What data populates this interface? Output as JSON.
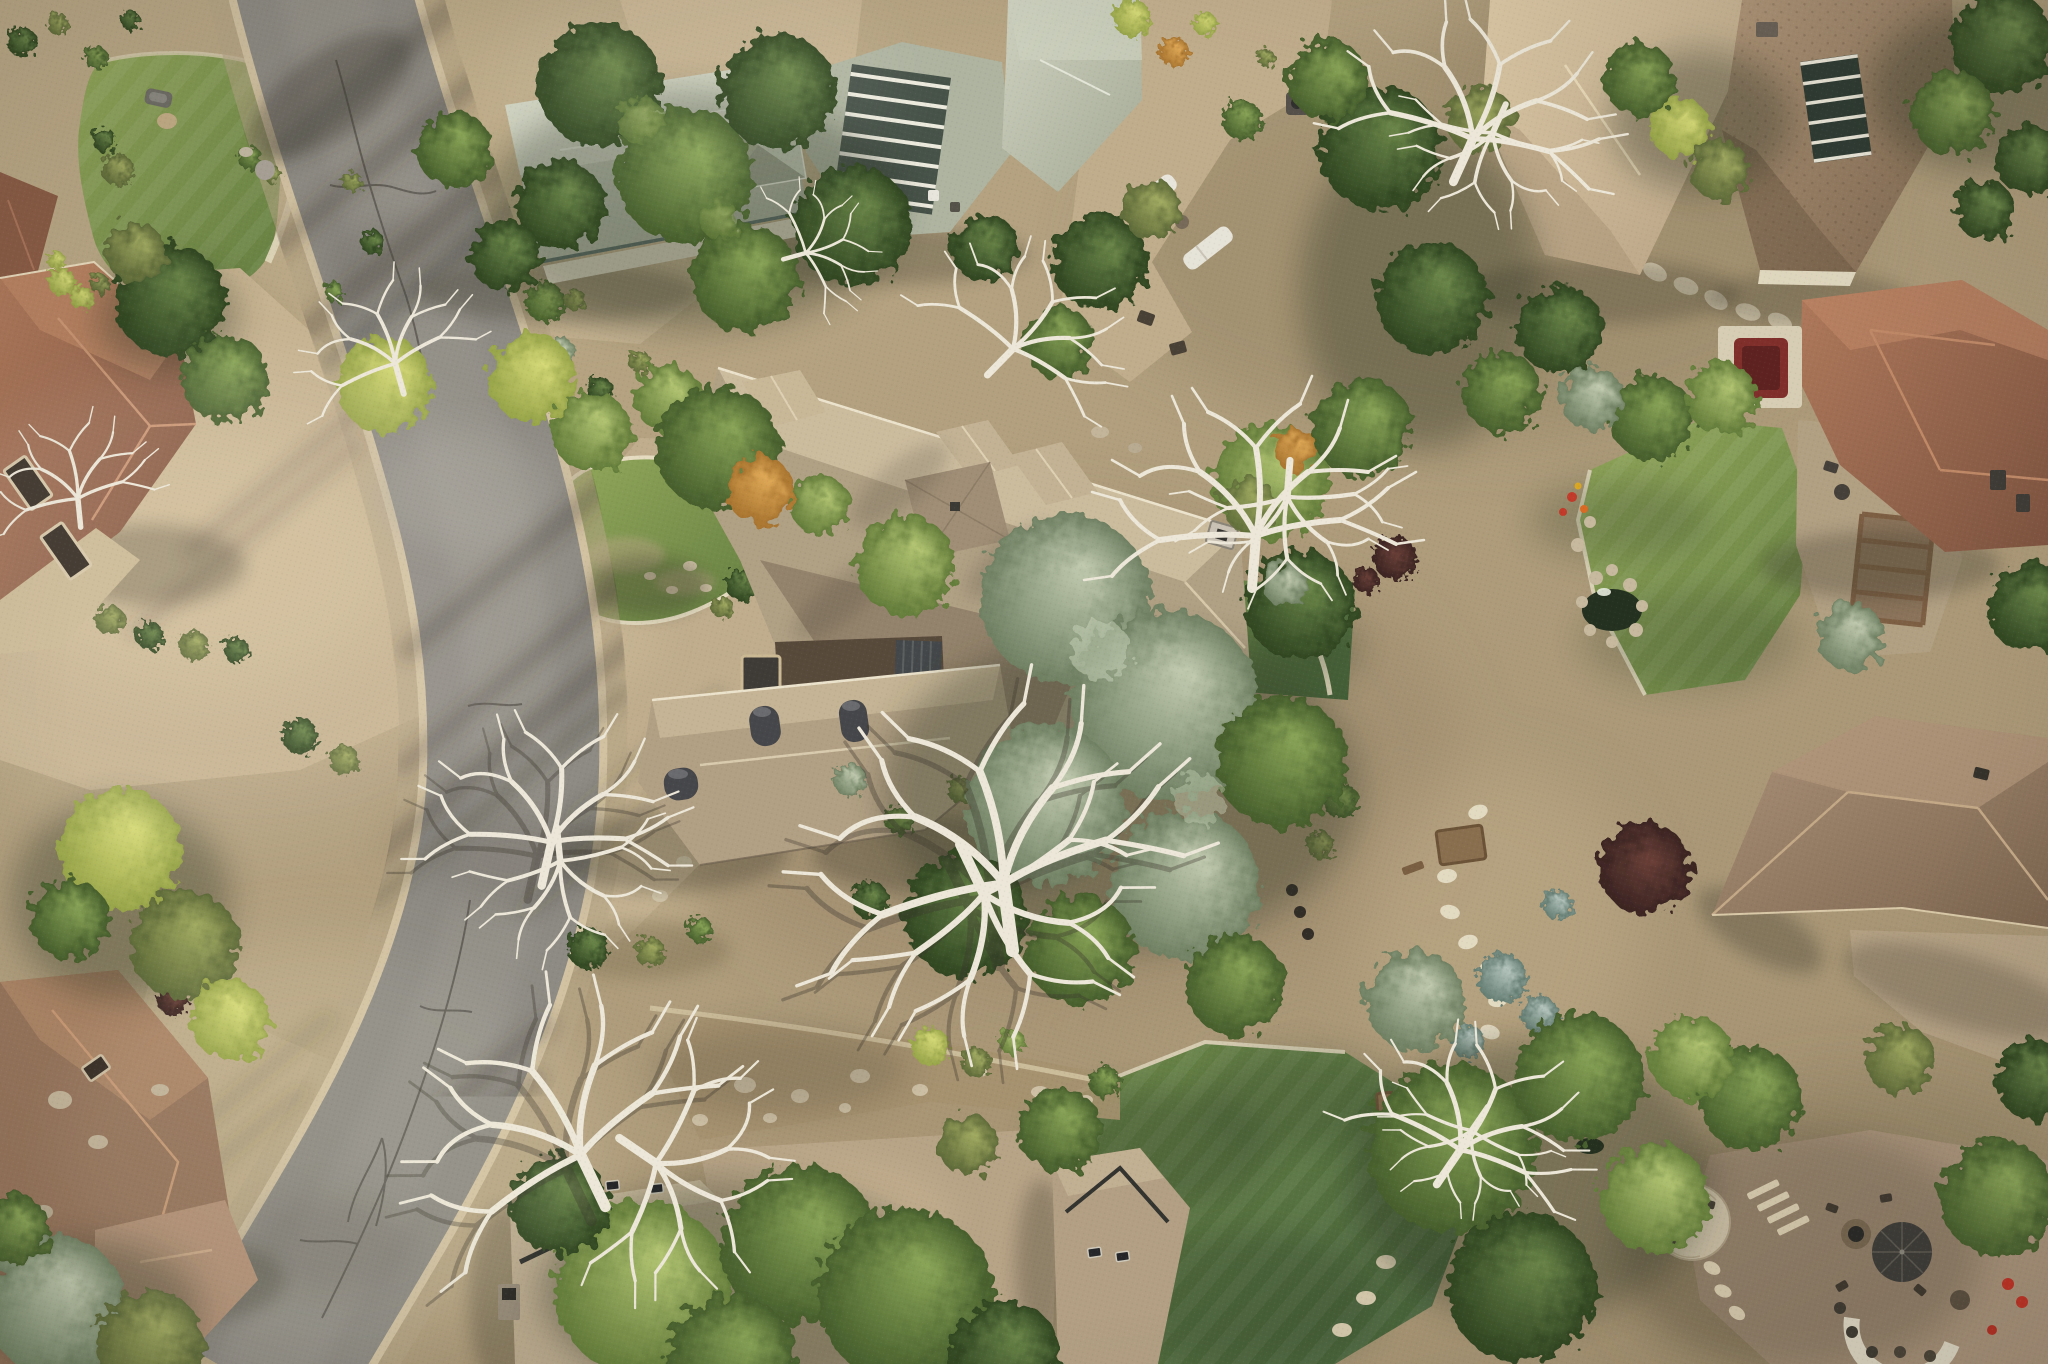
{
  "scene": {
    "type": "aerial-drone-photograph",
    "canvas": {
      "width": 2048,
      "height": 1364
    },
    "description": "Top-down aerial view of a wooded luxury residential neighborhood. A gray asphalt street curves along the left side. A large estate home with tan hip roofs, a brown inner courtyard and round metal chimneys sits at center behind a kidney-shaped lawn island and paver circular driveway. Neighboring homes have sage-green, terracotta, cream and brown roofs. Mature pines, silver conifers, autumn-tinted deciduous trees and bare white dead trees cover the lots, with lawns, patios, a fire-pit backyard, a pond and a dry creek bed. Shadows fall toward the lower left.",
    "palette": {
      "ground_tan": "#b3a181",
      "asphalt": "#8e8b84",
      "curb_concrete": "#d2c2a2",
      "paver_driveway": "#bfad8d",
      "main_roof_tan": "#b1a085",
      "sage_roof": "#b9beac",
      "terracotta_roof": "#9c7058",
      "cream_roof": "#cdb997",
      "brown_roof": "#a2896b",
      "dark_metal": "#45484a",
      "courtyard_brown": "#584a3b",
      "lawn_green": "#7d9450",
      "shaded_lawn": "#55703f",
      "pine_dark": "#3d5430",
      "silver_conifer": "#8fa08a",
      "chartreuse_tree": "#b9c25e",
      "autumn_orange": "#c08a3e",
      "dead_tree_white": "#ece7d8",
      "shadow": "#3a372c",
      "hot_tub_red": "#802f2b",
      "water_dark": "#243020"
    },
    "objects": [
      {
        "id": "street",
        "label": "curving asphalt street with concrete curbs, cracks and tree shadows"
      },
      {
        "id": "left-driveway",
        "label": "large tan driveway serving the left-side homes"
      },
      {
        "id": "upper-left-lawn",
        "label": "kidney-shaped lawn with stone curb, concrete path and small gray object"
      },
      {
        "id": "left-house-upper",
        "label": "terracotta tile roof home with two dark garage doors"
      },
      {
        "id": "left-house-lower",
        "label": "terracotta/brown roof home at lower left"
      },
      {
        "id": "top-house",
        "label": "sage-green shingle roof home with pyramidal cupola, slatted pergola and paver courts"
      },
      {
        "id": "northeast-patio",
        "label": "paver patio with two white chaise lounges, side table, fire table and dark chairs"
      },
      {
        "id": "top-right-house",
        "label": "home with cream and patterned brown roofs and dark skylight band with white mullions"
      },
      {
        "id": "right-terracotta-house",
        "label": "terracotta roof with chimneys and maroon hot tub on cream pad"
      },
      {
        "id": "pergola-patio",
        "label": "paver patio with wood pergola and outdoor furniture"
      },
      {
        "id": "right-lawn",
        "label": "manicured lawn with rock-edged pond, boulders and red-orange flowers"
      },
      {
        "id": "right-brown-house",
        "label": "large brown hip-roof home at right with rear driveway"
      },
      {
        "id": "central-estate",
        "label": "estate home with tan hip roofs, north dormers, chimney, three round metal chimneys, dark metal roof panels and brown flat courtyard"
      },
      {
        "id": "circular-drive",
        "label": "paver circular driveway with kidney lawn island, stone curb, flagstones and shrubs"
      },
      {
        "id": "pocket-lawn-east",
        "label": "small shaded lawn east of estate with white-edged path"
      },
      {
        "id": "garden-flagstone-path",
        "label": "garden with winding flagstone path, blue spruce mounds, raised planter beds and dark pots"
      },
      {
        "id": "dry-creek",
        "label": "dry creek bed with boulders and stone edging"
      },
      {
        "id": "bottom-lawn",
        "label": "shaded lawn with stone mow curb, boulders and stepping stones"
      },
      {
        "id": "bottom-houses",
        "label": "two gray-tan roofed homes with dark ridge caps, skylights and chimney flanking a driveway"
      },
      {
        "id": "backyard-firepit",
        "label": "backyard with flagstone sitting circle, fire bowl, stone steps, fire pit under dark umbrella, curved outdoor kitchen bar with stools and red chairs"
      },
      {
        "id": "water-feature",
        "label": "small rock waterfall and pool near bottom lawn"
      },
      {
        "id": "trees",
        "label": "pines, silver-green conifers, olive and chartreuse deciduous trees, autumn orange accents, bare white dead trees, maroon shrubs"
      }
    ],
    "lighting": "low sun from upper right; long soft shadows point to the lower left"
  }
}
